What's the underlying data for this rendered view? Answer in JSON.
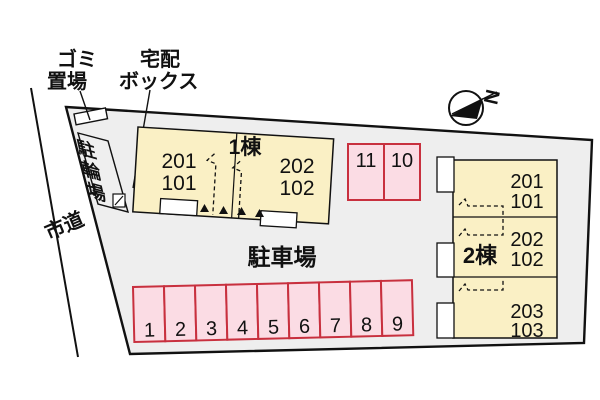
{
  "labels": {
    "garbage1": "ゴミ",
    "garbage2": "置場",
    "delivery1": "宅配",
    "delivery2": "ボックス",
    "bicycle": "駐輪場",
    "road": "市道",
    "parking_lot": "駐車場",
    "north": "N"
  },
  "building1": {
    "name": "1棟",
    "units": [
      {
        "upper": "201",
        "lower": "101"
      },
      {
        "upper": "202",
        "lower": "102"
      }
    ]
  },
  "building2": {
    "name": "2棟",
    "units": [
      {
        "upper": "201",
        "lower": "101"
      },
      {
        "upper": "202",
        "lower": "102"
      },
      {
        "upper": "203",
        "lower": "103"
      }
    ]
  },
  "parking": {
    "row": [
      "1",
      "2",
      "3",
      "4",
      "5",
      "6",
      "7",
      "8",
      "9"
    ],
    "upper": [
      "11",
      "10"
    ]
  },
  "colors": {
    "site_fill": "#eeeeee",
    "building_fill": "#faf0c5",
    "stall_fill": "#fbdce4",
    "stall_border": "#c8303e",
    "line": "#111111"
  }
}
